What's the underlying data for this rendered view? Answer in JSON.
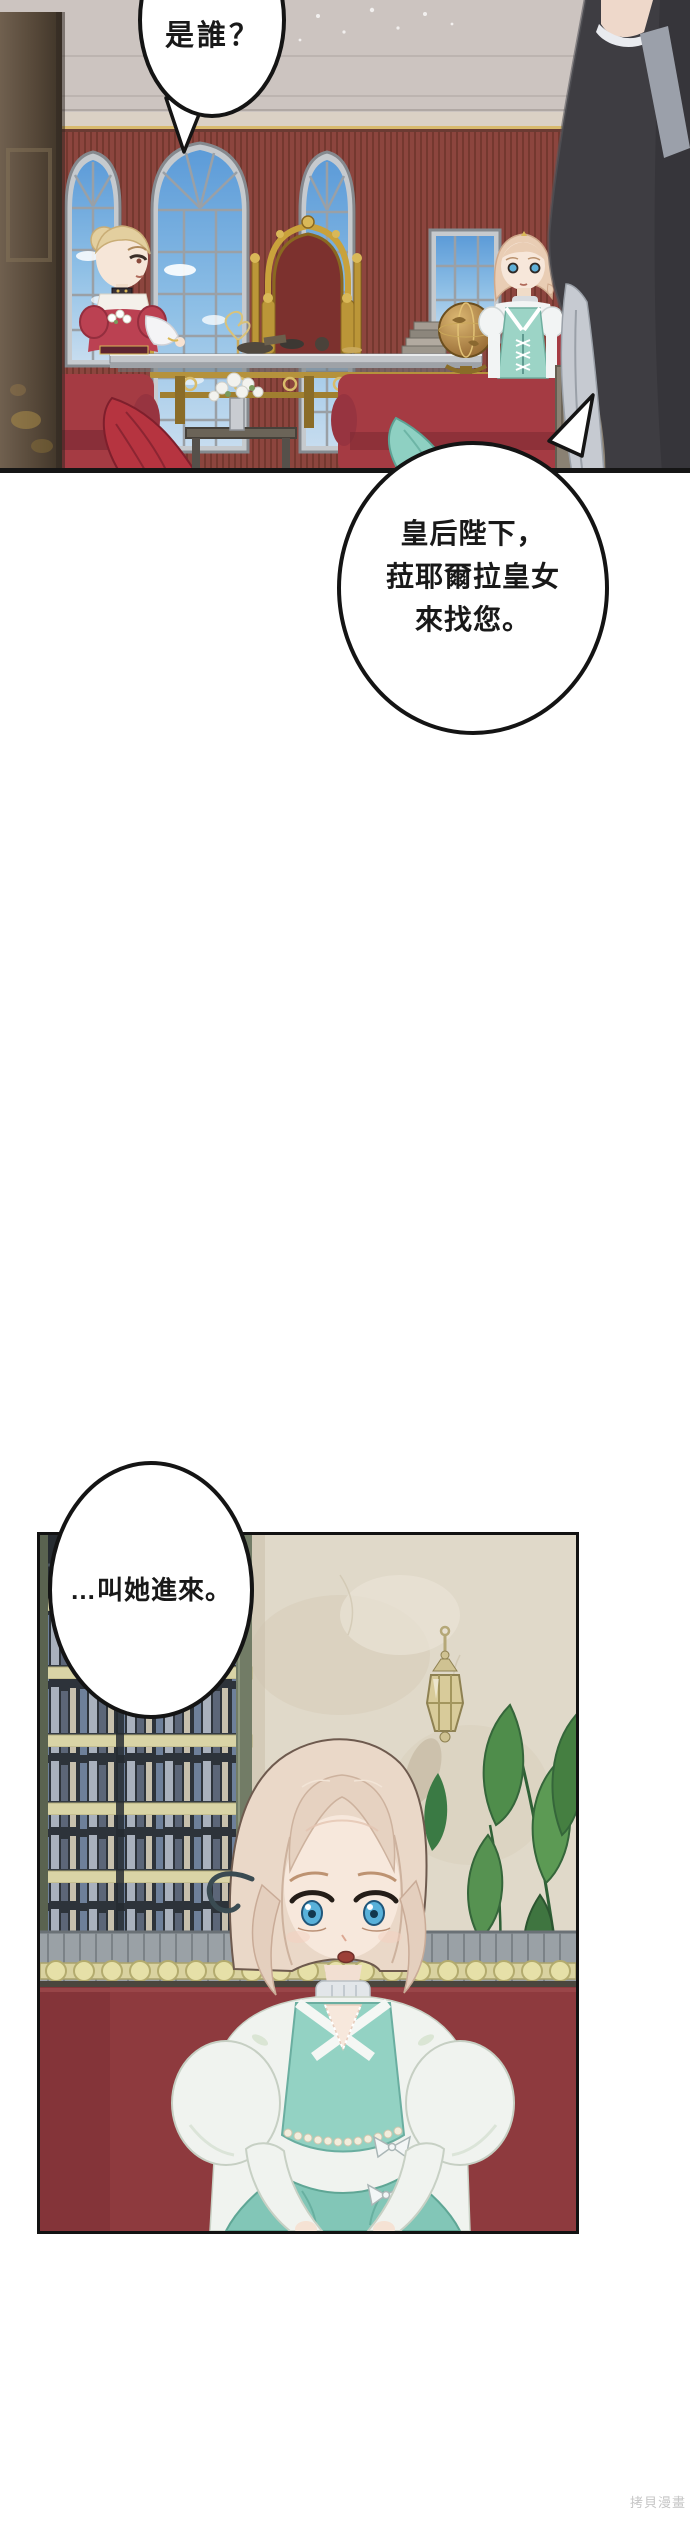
{
  "page": {
    "width": 690,
    "height": 2521,
    "background_color": "#ffffff"
  },
  "speech_bubbles": {
    "bubble_top": {
      "text": "是誰？"
    },
    "bubble_middle": {
      "lines": [
        "皇后陛下，",
        "菈耶爾拉皇女",
        "來找您。"
      ]
    },
    "bubble_bottom": {
      "text": "…叫她進來。"
    }
  },
  "watermark": {
    "text": "拷貝漫畫",
    "color": "#c6c6c6"
  },
  "palette": {
    "wall_maroon": "#8c453e",
    "ceiling_gray": "#ccc4c0",
    "sky_blue": "#5c9bd8",
    "couch_red": "#a53b43",
    "panel_couch_red": "#8e3a3e",
    "gold_trim": "#c9a23c",
    "teal_dress": "#93d2c3",
    "maid_charcoal": "#3e3d42",
    "marble_beige": "#e0d9c9",
    "bookshelf_dark": "#333a41",
    "rail_gold": "#d9d2a0",
    "plant_green": "#55924e",
    "hair_blonde": "#ead8c8",
    "eye_blue": "#58b1da"
  }
}
